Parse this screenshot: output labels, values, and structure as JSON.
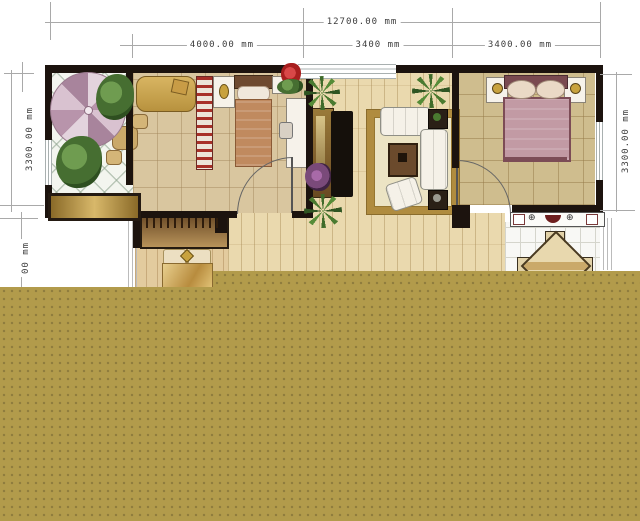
{
  "dims": {
    "top_total": "12700.00 mm",
    "seg_left": "4000.00 mm",
    "seg_mid": "3400 mm",
    "seg_right": "3400.00 mm",
    "left_upper": "3300.00 mm",
    "left_lower_partial": "00 mm",
    "right_side": "3300.00 mm"
  },
  "icons": {
    "stove_burner": "⊕",
    "sink_drain": "⊙"
  },
  "palette": {
    "wall": "#1c130e",
    "overlay_gold": "#b29b4b",
    "overlay_gold_dot": "#8e7c3e",
    "dim_line": "#a9a9a9",
    "dim_text": "#3c3c3c",
    "wood_floor": "#ead9ae",
    "tile_beige": "#d9c69f",
    "tile_tan": "#cfbd8e",
    "rug_border": "#b08c3f",
    "rug_center": "#ece4c4",
    "bed_mauve": "#c29aa4",
    "umbrella_pink": "#d9c2d0"
  }
}
